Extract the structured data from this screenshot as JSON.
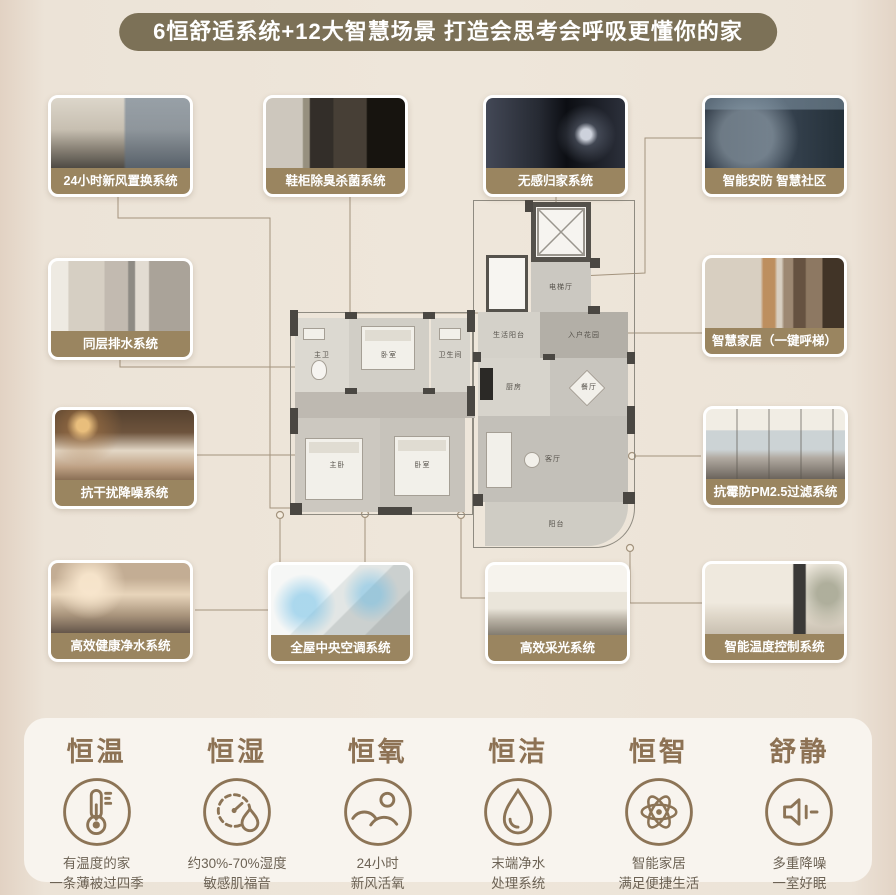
{
  "banner": {
    "title": "6恒舒适系统+12大智慧场景 打造会思考会呼吸更懂你的家"
  },
  "cards": [
    {
      "label": "24小时新风置换系统",
      "photo": "阳光客厅落地窗城市景观"
    },
    {
      "label": "鞋柜除臭杀菌系统",
      "photo": "玄关鞋柜"
    },
    {
      "label": "无感归家系统",
      "photo": "夜间手机智能门锁开门"
    },
    {
      "label": "智能安防 智慧社区",
      "photo": "智慧社区安防监控屏"
    },
    {
      "label": "同层排水系统",
      "photo": "卫浴间"
    },
    {
      "label": "抗干扰降噪系统",
      "photo": "安睡中的卧室"
    },
    {
      "label": "智慧家居（一键呼梯）",
      "photo": "电梯厅走廊控制面板"
    },
    {
      "label": "抗霉防PM2.5过滤系统",
      "photo": "落地窗明亮客厅"
    },
    {
      "label": "高效健康净水系统",
      "photo": "厨房净水亲子"
    },
    {
      "label": "全屋中央空调系统",
      "photo": "中央空调气流示意图"
    },
    {
      "label": "高效采光系统",
      "photo": "高采光客餐厅"
    },
    {
      "label": "智能温度控制系统",
      "photo": "客厅立式空调"
    }
  ],
  "floorplan": {
    "rooms": [
      {
        "name": "电梯厅"
      },
      {
        "name": "入户花园"
      },
      {
        "name": "生活阳台"
      },
      {
        "name": "厨房"
      },
      {
        "name": "餐厅"
      },
      {
        "name": "客厅"
      },
      {
        "name": "阳台"
      },
      {
        "name": "主卧"
      },
      {
        "name": "卧室"
      },
      {
        "name": "卧室"
      },
      {
        "name": "主卫"
      },
      {
        "name": "卫生间"
      }
    ]
  },
  "features": [
    {
      "title": "恒温",
      "icon": "thermometer-icon",
      "desc_line1": "有温度的家",
      "desc_line2": "一条薄被过四季"
    },
    {
      "title": "恒湿",
      "icon": "humidity-gauge-icon",
      "desc_line1": "约30%-70%湿度",
      "desc_line2": "敏感肌福音"
    },
    {
      "title": "恒氧",
      "icon": "fresh-air-landscape-icon",
      "desc_line1": "24小时",
      "desc_line2": "新风活氧"
    },
    {
      "title": "恒洁",
      "icon": "water-drop-icon",
      "desc_line1": "末端净水",
      "desc_line2": "处理系统"
    },
    {
      "title": "恒智",
      "icon": "smart-atom-icon",
      "desc_line1": "智能家居",
      "desc_line2": "满足便捷生活"
    },
    {
      "title": "舒静",
      "icon": "quiet-speaker-icon",
      "desc_line1": "多重降噪",
      "desc_line2": "一室好眠"
    }
  ],
  "colors": {
    "page_bg": "#ece3d7",
    "banner_bg": "#7c7157",
    "card_label_bg": "#9a8560",
    "accent_brown": "#8d7254",
    "panel_bg": "#f8f4ee",
    "line": "#a3937d"
  }
}
